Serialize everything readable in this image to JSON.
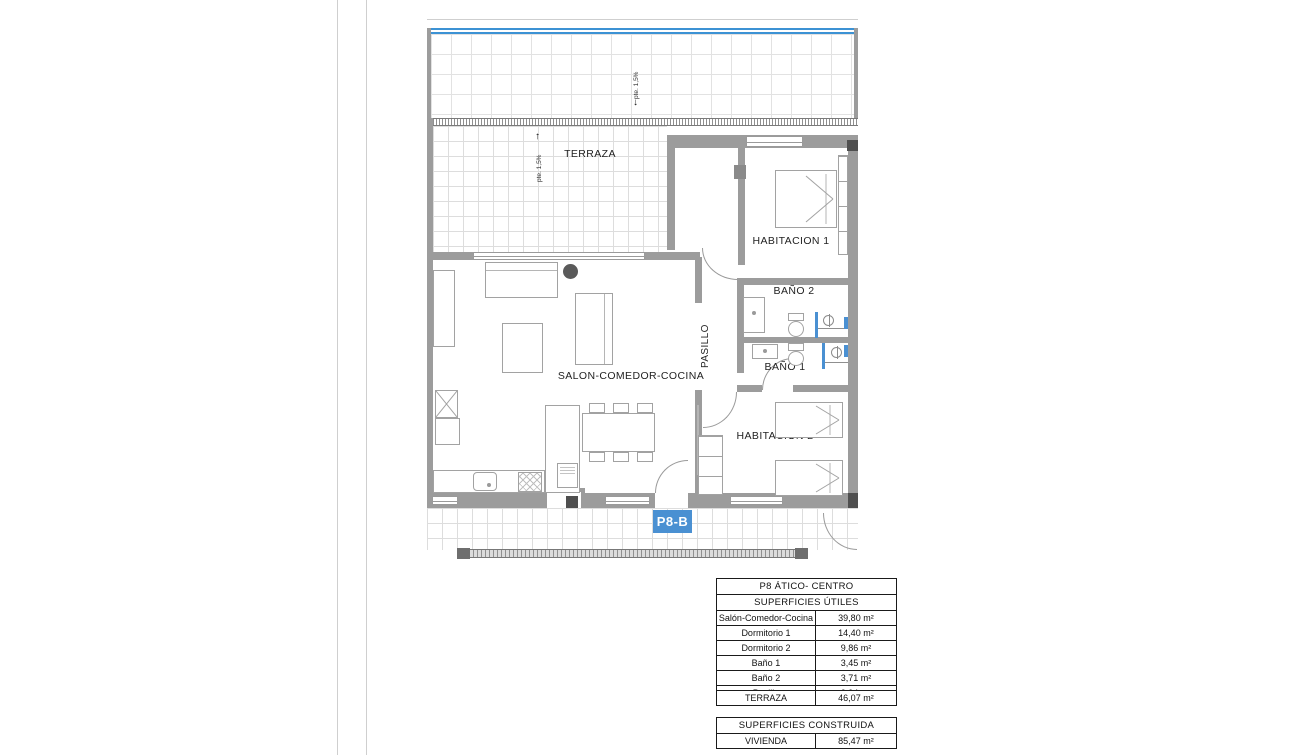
{
  "plan": {
    "badge": "P8-B",
    "labels": {
      "terraza": "TERRAZA",
      "salon": "SALON-COMEDOR-COCINA",
      "pasillo": "PASILLO",
      "habitacion1": "HABITACION 1",
      "habitacion2": "HABITACION 2",
      "bano1": "BAÑO 1",
      "bano2": "BAÑO 2"
    },
    "annotations": {
      "slope": "pte. 1,5%"
    },
    "icons": {
      "arrow_down": "↓",
      "arrow_up": "↑"
    },
    "colors": {
      "edge_blue": "#3c92d4",
      "badge_blue": "#4a90d2",
      "shower_blue": "#4a90d2",
      "wall_gray": "#9c9c9c"
    }
  },
  "tables": {
    "useful": {
      "title": "P8 ÁTICO- CENTRO",
      "subtitle": "SUPERFICIES ÚTILES",
      "rows": [
        [
          "Salón-Comedor-Cocina",
          "39,80 m²"
        ],
        [
          "Dormitorio 1",
          "14,40 m²"
        ],
        [
          "Dormitorio 2",
          "9,86 m²"
        ],
        [
          "Baño 1",
          "3,45 m²"
        ],
        [
          "Baño 2",
          "3,71 m²"
        ],
        [
          "Pasillo",
          "2,94 m²"
        ]
      ]
    },
    "terrace": {
      "label": "TERRAZA",
      "value": "46,07 m²"
    },
    "built": {
      "title": "SUPERFICIES CONSTRUIDA",
      "rows": [
        [
          "VIVIENDA",
          "85,47 m²"
        ]
      ]
    }
  }
}
